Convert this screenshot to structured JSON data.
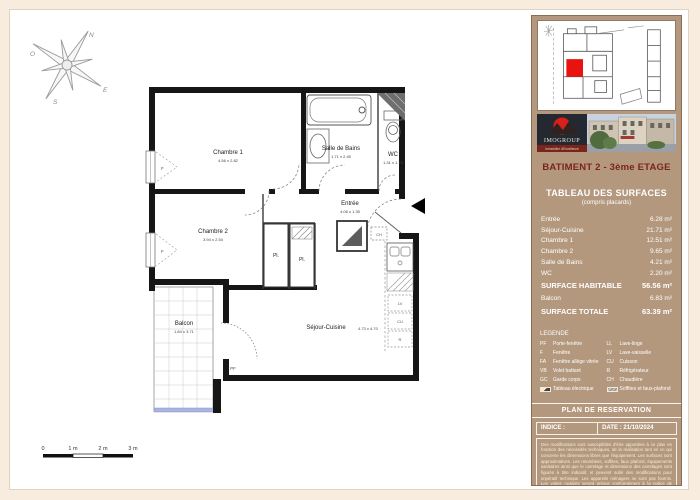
{
  "compass": {
    "n": "N",
    "e": "E",
    "s": "S",
    "o": "O"
  },
  "plan": {
    "rooms": {
      "chambre1": {
        "name": "Chambre 1",
        "dims": "4.56 x 2.82"
      },
      "salle_de_bains": {
        "name": "Salle de Bains",
        "dims": "1.71 x 2.45"
      },
      "wc": {
        "name": "WC",
        "dims": "1.31 x 1.74"
      },
      "entree": {
        "name": "Entrée",
        "dims": "4.06 x 1.35"
      },
      "chambre2": {
        "name": "Chambre 2",
        "dims": "3.94 x 2.54"
      },
      "sejour": {
        "name": "Séjour-Cuisine",
        "dims": "4.73 x 4.70"
      },
      "balcon": {
        "name": "Balcon",
        "dims": "1.84 x 3.71"
      }
    },
    "fixtures": {
      "placard": "Pl.",
      "pf": "PF",
      "window": "F",
      "ch": "CH",
      "lv": "LV",
      "cu": "CU",
      "r": "R"
    },
    "scale_bar": {
      "t0": "0",
      "t1": "1 m",
      "t2": "2 m",
      "t3": "3 m"
    }
  },
  "sidebar": {
    "logo": {
      "brand": "IMOGROUP",
      "tagline": "Immobilier d'Excellence"
    },
    "building_title": "BATIMENT 2 - 3ème ETAGE",
    "surfaces": {
      "title": "TABLEAU DES SURFACES",
      "subtitle": "(compris placards)",
      "rows": [
        {
          "label": "Entrée",
          "value": "6.28 m²"
        },
        {
          "label": "Séjour-Cuisine",
          "value": "21.71 m²"
        },
        {
          "label": "Chambre 1",
          "value": "12.51 m²"
        },
        {
          "label": "Chambre 2",
          "value": "9.65 m²"
        },
        {
          "label": "Salle de Bains",
          "value": "4.21 m²"
        },
        {
          "label": "WC",
          "value": "2.20 m²"
        },
        {
          "label": "SURFACE HABITABLE",
          "value": "56.56 m²"
        },
        {
          "label": "Balcon",
          "value": "6.83 m²"
        },
        {
          "label": "SURFACE TOTALE",
          "value": "63.39 m²"
        }
      ]
    },
    "legend": {
      "title": "LEGENDE",
      "left": [
        {
          "abbr": "PF",
          "label": "Porte-fenêtre"
        },
        {
          "abbr": "F",
          "label": "Fenêtre"
        },
        {
          "abbr": "FA",
          "label": "Fenêtre allège vitrée"
        },
        {
          "abbr": "VB",
          "label": "Volet battant"
        },
        {
          "abbr": "GC",
          "label": "Garde corps"
        },
        {
          "abbr": "",
          "label": "Tableau électrique"
        }
      ],
      "right": [
        {
          "abbr": "LL",
          "label": "Lave-linge"
        },
        {
          "abbr": "LV",
          "label": "Lave-vaisselle"
        },
        {
          "abbr": "CU",
          "label": "Cuisson"
        },
        {
          "abbr": "R",
          "label": "Réfrigérateur"
        },
        {
          "abbr": "CH",
          "label": "Chaudière"
        },
        {
          "abbr": "",
          "label": "Soffites et faux-plafond"
        }
      ]
    },
    "reservation_title": "PLAN DE RESERVATION",
    "indice_label": "INDICE :",
    "date_label": "DATE :  21/10/2024",
    "disclaimer": "Des modifications sont susceptibles d'être apportées à ce plan en fonction des nécessités techniques, de la réalisation tant en ce qui concerne les dimensions libres que l'équipement. Les surfaces sont approximatives. Les retombées, soffites, faux plafond, équipements sanitaires ainsi que le carrelage et dimensions des carrelages sont figurés à titre indicatif, et peuvent subir des modifications pour impératif technique. Les appareils ménagers ne sont pas fournis. Les volets roulants seront prévus conformément à la notice de vente. Les coffres de volet roulant ne sont pas représentés et seront débordants à l'intérieur. La hauteur des seuils au droit des porte-fenêtres sur balcons ou terrasses pourra varier de 8 à 20 cm à partir du sol intérieur. La hauteur entre le jardin et la terrasse pourra varier entre 0 et 60 cm. Les jardins ne seront pas nécessairement plats et pourront comporter des talus et des pentes."
  }
}
